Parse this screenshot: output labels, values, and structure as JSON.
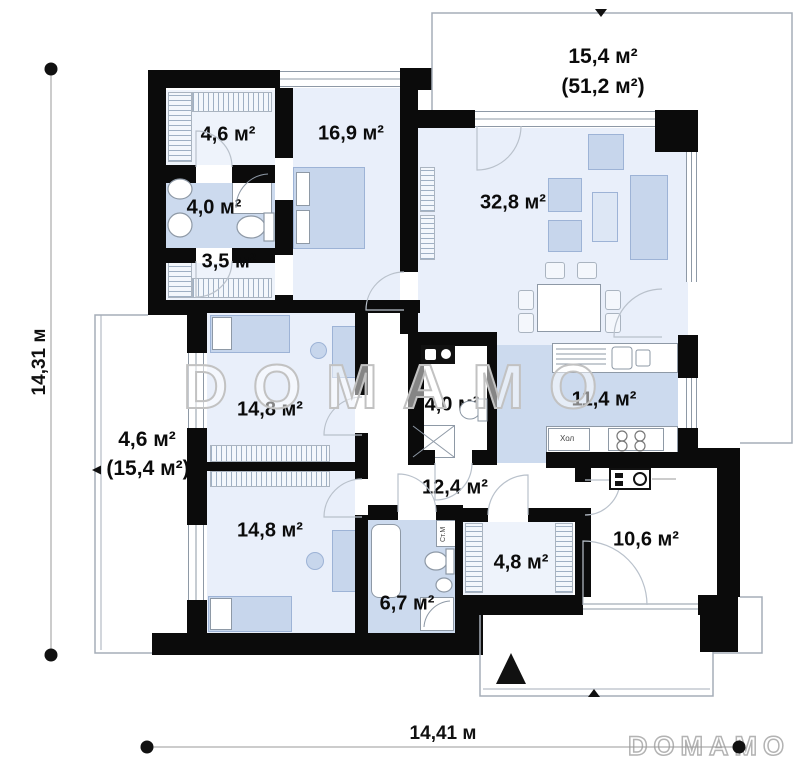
{
  "plan": {
    "rooms": {
      "wardrobe_top": "4,6 м²",
      "bedroom_master": "16,9 м²",
      "bathroom_top": "4,0 м²",
      "wardrobe_small": "3,5 м²",
      "living_room": "32,8 м²",
      "bedroom_left": "14,8 м²",
      "bathroom_middle": "4,0 м²",
      "kitchen": "11,4 м²",
      "hallway": "12,4 м²",
      "bedroom_bottom": "14,8 м²",
      "bathroom_bottom": "6,7 м²",
      "wardrobe_bottom": "4,8 м²",
      "utility_room": "10,6 м²"
    },
    "terrace_top": {
      "area": "15,4 м²",
      "area_total": "(51,2 м²)"
    },
    "terrace_left": {
      "area": "4,6 м²",
      "area_total": "(15,4 м²)"
    },
    "dimensions": {
      "height": "14,31 м",
      "width": "14,41 м"
    },
    "appliances": {
      "fridge": "Хол",
      "washing_machine": "Ст.М"
    },
    "watermark": "DOMAMO",
    "logo": "DOMAMO",
    "colors": {
      "wall": "#0b0b0b",
      "floor_light": "#e9effa",
      "floor_blue": "#ccdaee",
      "furniture": "#c7d6ec",
      "watermark": "#c2c2c2"
    }
  }
}
